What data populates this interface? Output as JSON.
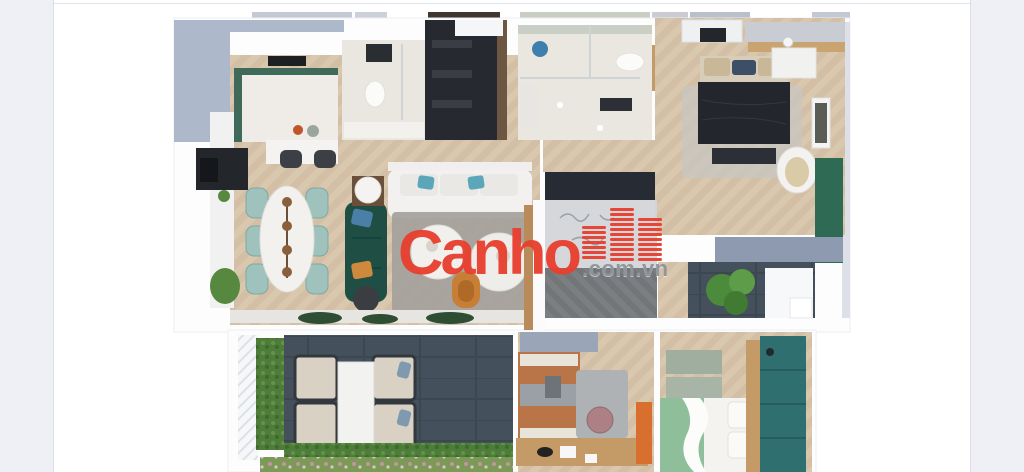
{
  "watermark": {
    "brand": "Canho",
    "suffix": ".com.vn",
    "icon": "buildings-icon"
  },
  "content": {
    "description": "3D top-down rendered apartment floor plan, no text labels"
  },
  "colors": {
    "margin-gray": "#eef0f5",
    "content-white": "#ffffff",
    "divider": "#dfe2ea",
    "brand-red": "#e8402f",
    "suffix-gray": "#8f959c",
    "wall-white": "#fdfdfe",
    "wall-blue": "#aeb8cb",
    "wall-blue-light": "#8e9ab0",
    "wood-light-a": "#d9c7ae",
    "wood-light-b": "#ccb89e",
    "wood-dark-a": "#7b7f81",
    "wood-dark-b": "#6e7275",
    "marble": "#eae7e1",
    "slate": "#44505b",
    "slate-stripe": "#3c4752",
    "hedge-green": "#4e7d3a",
    "plant-green": "#57883f",
    "sofa-teal": "#1f4f44",
    "chair-teal": "#9fc2bd",
    "accent-green": "#2e6a54",
    "wardrobe-teal": "#2f6f70",
    "orange": "#c77e36",
    "terracotta": "#b97447",
    "charcoal": "#26292f",
    "tv-dark": "#272c34",
    "bed-dark": "#23262d",
    "tan-wood": "#c49a66",
    "rug-gray": "#a3a09b",
    "glass-gray": "#d3d5d9",
    "bed-green": "#8fbf9a"
  }
}
